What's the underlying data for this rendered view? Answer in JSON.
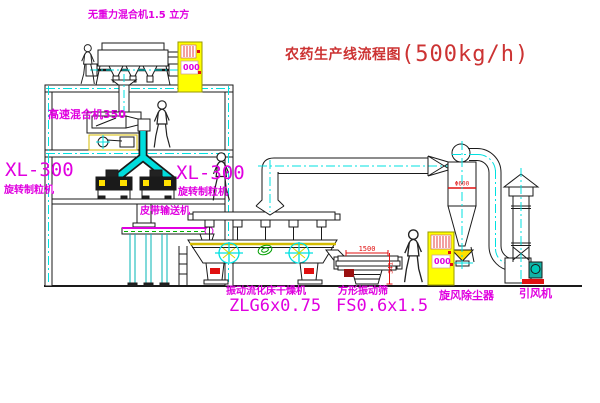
{
  "title": {
    "zh": "农药生产线流程图",
    "capacity": "(500kg/h)"
  },
  "labels": {
    "gravity_mixer": "无重力混合机1.5 立方",
    "high_speed_mixer": "高速混合机350",
    "granulator_left_model": "XL-300",
    "granulator_left_name": "旋转制粒机",
    "granulator_right_model": "XL-300",
    "granulator_right_name": "旋转制粒机",
    "belt_conveyor": "皮带输送机",
    "dryer_name": "振动流化床干燥机",
    "dryer_model": "ZLG6x0.75",
    "screen_name": "方形振动筛",
    "screen_model": "FS0.6x1.5",
    "cyclone": "旋风除尘器",
    "fan": "引风机"
  },
  "dimensions": {
    "screen_width": "1500",
    "screen_height": "341",
    "cyclone_dia": "Φ600"
  },
  "control_panels": {
    "panel1_display": "000",
    "panel2_display": "000"
  },
  "colors": {
    "line": "#1a1a1a",
    "centerline_cyan": "#00e0e0",
    "label_magenta": "#e000e0",
    "dimension_red": "#e01010",
    "title_red": "#cc3333",
    "cabinet_yellow": "#ffff00",
    "conveyor_green": "#00b000",
    "fan_teal": "#12b2a5"
  }
}
